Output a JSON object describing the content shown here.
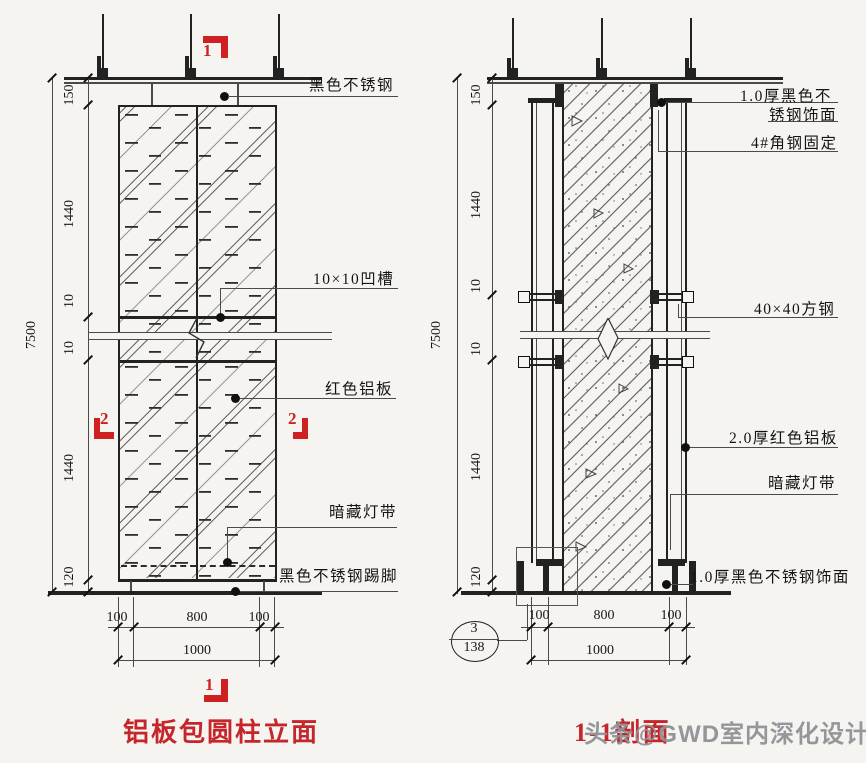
{
  "colors": {
    "red_mark": "#cf2121",
    "red_title": "#c5262b",
    "line": "#222222",
    "watermark_gray": "#8f9296",
    "paper": "#f5f4f1"
  },
  "left": {
    "title": "铝板包圆柱立面",
    "marks": {
      "top": "1",
      "bottom": "1",
      "left": "2",
      "right": "2"
    },
    "callouts": {
      "top": "黑色不锈钢",
      "groove": "10×10凹槽",
      "panel": "红色铝板",
      "light": "暗藏灯带",
      "skirting": "黑色不锈钢踢脚"
    },
    "dims": {
      "overall": "7500",
      "top": "150",
      "upper": "1440",
      "groove1": "10",
      "groove2": "10",
      "lower": "1440",
      "base": "120",
      "b_left": "100",
      "b_mid": "800",
      "b_right": "100",
      "b_total": "1000"
    }
  },
  "right": {
    "title": "1-1剖面",
    "callouts": {
      "ss_top_1": "1.0厚黑色不",
      "ss_top_2": "锈钢饰面",
      "angle": "4#角钢固定",
      "steel": "40×40方钢",
      "alum": "2.0厚红色铝板",
      "light": "暗藏灯带",
      "ss_bottom": "1.0厚黑色不锈钢饰面"
    },
    "detail_ref": {
      "num": "3",
      "sheet": "138"
    },
    "dims": {
      "overall": "7500",
      "top": "150",
      "upper": "1440",
      "groove1": "10",
      "groove2": "10",
      "lower": "1440",
      "base": "120",
      "b_left": "100",
      "b_mid": "800",
      "b_right": "100",
      "b_total": "1000"
    }
  },
  "watermark": "头条@GWD室内深化设计"
}
